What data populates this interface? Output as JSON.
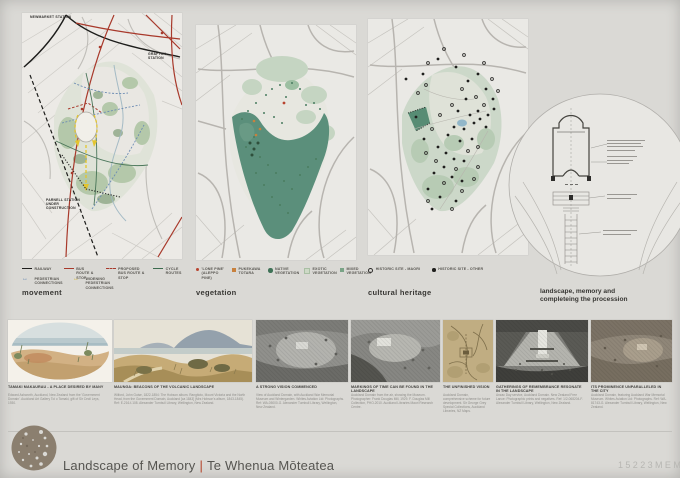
{
  "colors": {
    "board_bg": "#dad9d5",
    "accent_red": "#a8392b",
    "route_yellow": "#d4b32a",
    "pedestrian_blue": "#5a7fae",
    "vegetation_teal": "#5b8f7b",
    "logo_brown": "#8b7f6f"
  },
  "maps": [
    {
      "title": "movement",
      "labels": {
        "newmarket": "NEWMARKET STATION",
        "grafton": "GRAFTON STATION",
        "parnell": "PARNELL STATION UNDER CONSTRUCTION"
      },
      "legend": [
        {
          "label": "RAILWAY",
          "icon": "black-line-icon"
        },
        {
          "label": "BUS ROUTE & STOP",
          "icon": "red-line-icon"
        },
        {
          "label": "PROPOSED BUS ROUTE & STOP",
          "icon": "red-dashed-line-icon"
        },
        {
          "label": "CYCLE ROUTES",
          "icon": "green-line-icon"
        },
        {
          "label": "PEDESTRIAN CONNECTIONS",
          "icon": "blue-arrows-icon"
        },
        {
          "label": "WIDENING PEDESTRIAN CONNECTIONS",
          "icon": "yellow-arrows-icon"
        }
      ]
    },
    {
      "title": "vegetation",
      "legend": [
        {
          "label": "'LONE PINE' (ALEPPO PINE)",
          "icon": "red-dot-icon"
        },
        {
          "label": "PUKEKAWA TOTARA",
          "icon": "orange-square-icon"
        },
        {
          "label": "NATIVE VEGETATION",
          "icon": "dark-green-dot-icon"
        },
        {
          "label": "EXOTIC VEGETATION",
          "icon": "light-green-square-icon"
        },
        {
          "label": "MIXED VEGETATION",
          "icon": "mid-green-square-icon"
        }
      ]
    },
    {
      "title": "cultural heritage",
      "legend": [
        {
          "label": "HISTORIC SITE - MAORI",
          "icon": "open-circle-icon"
        },
        {
          "label": "HISTORIC SITE - OTHER",
          "icon": "filled-circle-icon"
        }
      ]
    }
  ],
  "diagram": {
    "title": "landscape, memory and completeing the procession"
  },
  "gallery": [
    {
      "title": "TAMAKI MAKAURAU - A PLACE DESIRED BY MANY",
      "caption": "Edward Ashworth, Auckland, New Zealand from the 'Government Domain'. Auckland Art Gallery Toi o Tamaki, gift of Sir Cecil Leys, 1930."
    },
    {
      "title": "MAUNGA: BEACONS OF THE VOLCANIC LANDSCAPE",
      "caption": "Wilford, John Guise, 1822-1854: The Hobson album. Rangitoto, Mount Victoria and the North Head, from the Government Domain, Auckland [ca 1843] (Mrs Hobson's album, 1843-1845). Ref: E-216-f-108. Alexander Turnbull Library, Wellington, New Zealand."
    },
    {
      "title": "A STRONG VISION COMMENCED",
      "caption": "View of Auckland Domain, with Auckland War Memorial Museum and Wintergarden. Whites Aviation Ltd: Photographs. Ref: WA-05000-G. Alexander Turnbull Library, Wellington, New Zealand."
    },
    {
      "title": "MARKINGS OF TIME CAN BE FOUND IN THE LANDSCAPE",
      "caption": "Auckland Domain from the air, showing the Museum. Photographer: Frank Douglas Mill, 1929. F. Douglas Mill Collection, PHO-2010. Auckland Libraries Maori Research Centre."
    },
    {
      "title": "THE UNFINISHED VISION",
      "caption": "Auckland Domain, comprehensive scheme for future development. Sir George Grey Special Collections, Auckland Libraries, NZ Maps."
    },
    {
      "title": "GATHERINGS OF REMEMBRANCE RESONATE IN THE LANDSCAPE",
      "caption": "Anzac Day service, Auckland Domain. New Zealand Free Lance: Photographic prints and negatives. Ref: 1/2-068204-F. Alexander Turnbull Library, Wellington, New Zealand."
    },
    {
      "title": "ITS PROMINENCE UNPARALLELED IN THE CITY",
      "caption": "Auckland Domain, featuring Auckland War Memorial Museum. Whites Aviation Ltd: Photographs. Ref: WA-81743-G. Alexander Turnbull Library, Wellington, New Zealand."
    }
  ],
  "footer": {
    "title": "Landscape of Memory",
    "separator": "|",
    "subtitle": "Te Whenua Mōteatea",
    "code": "15223MEM"
  }
}
